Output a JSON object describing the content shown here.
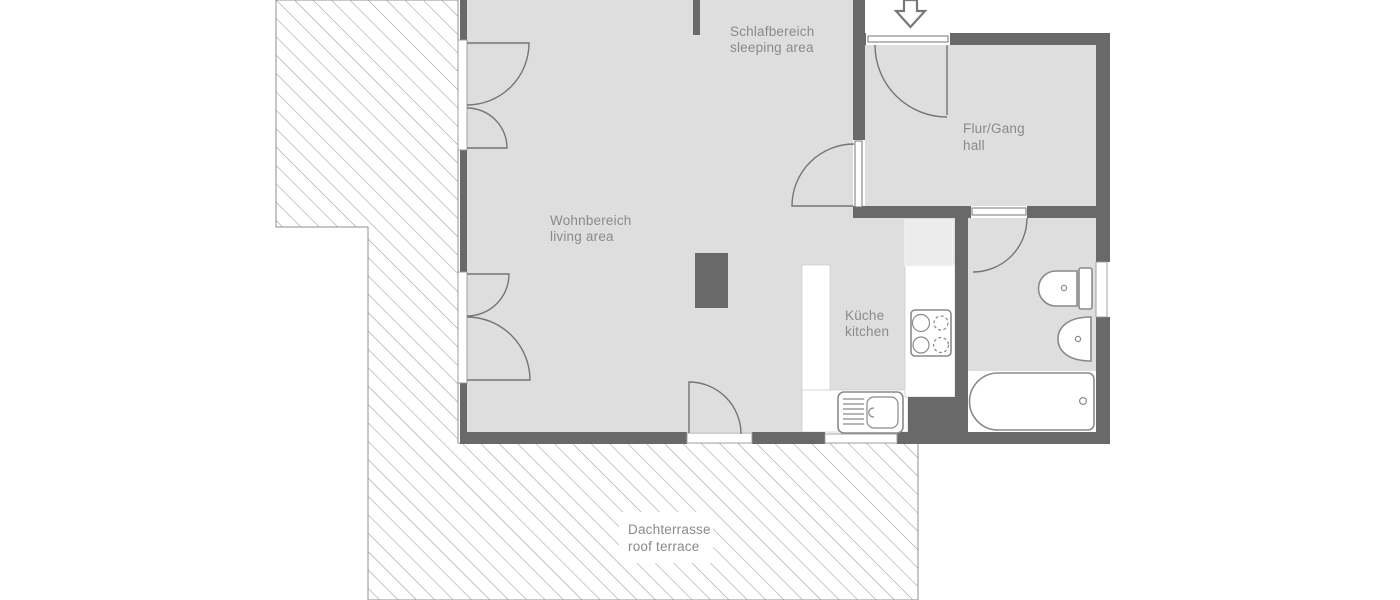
{
  "plan_type": "apartment floor plan",
  "rooms": {
    "sleeping": {
      "label_de": "Schlafbereich",
      "label_en": "sleeping area"
    },
    "living": {
      "label_de": "Wohnbereich",
      "label_en": "living area"
    },
    "kitchen": {
      "label_de": "Küche",
      "label_en": "kitchen"
    },
    "hall": {
      "label_de": "Flur/Gang",
      "label_en": "hall"
    },
    "terrace": {
      "label_de": "Dachterrasse",
      "label_en": "roof terrace"
    }
  },
  "fixtures": {
    "entrance_arrow": "entrance-arrow-icon",
    "toilet": "toilet-icon",
    "washbasin": "washbasin-icon",
    "bathtub": "bathtub-icon",
    "cooktop": "cooktop-icon",
    "kitchen_sink": "kitchen-sink-icon",
    "chimney": "chimney-block"
  },
  "colors": {
    "background": "#ffffff",
    "wall": "#696969",
    "floor": "#dedede",
    "appliance_fill": "#ececec",
    "hatch_line": "#9a9a9a",
    "label_text": "#8a8a8a",
    "door_line": "#757575",
    "fixture_line": "#8a8a8a"
  }
}
